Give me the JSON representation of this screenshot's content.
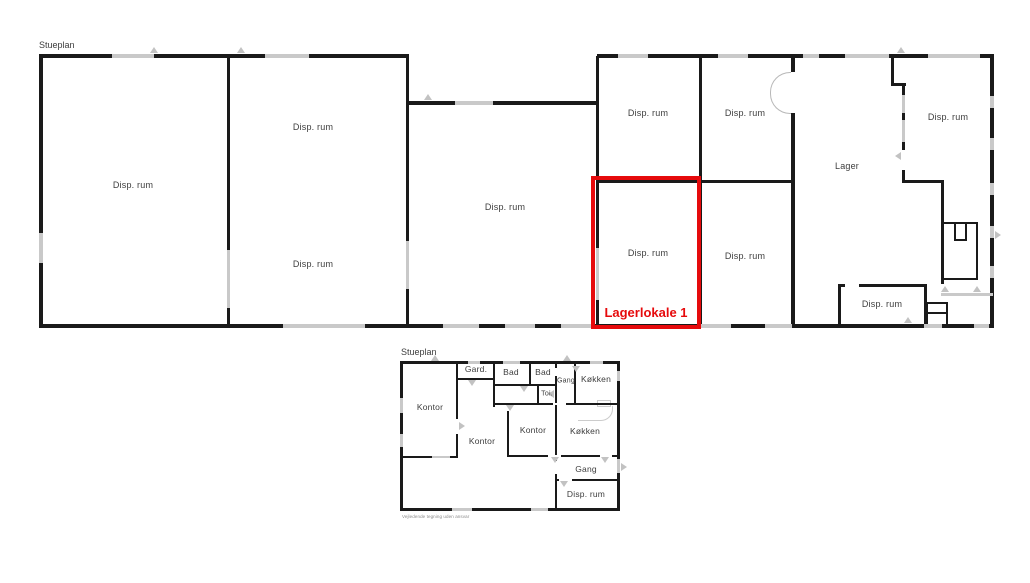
{
  "colors": {
    "wall": "#1a1a1a",
    "window": "#c9c9c9",
    "label_text": "#3d3d3d",
    "highlight_red": "#e60a0c",
    "disclaimer_text": "#8a8a8a"
  },
  "top_plan": {
    "title": "Stueplan",
    "rooms": [
      {
        "label": "Disp. rum"
      },
      {
        "label": "Disp. rum"
      },
      {
        "label": "Disp. rum"
      },
      {
        "label": "Disp. rum"
      },
      {
        "label": "Disp. rum"
      },
      {
        "label": "Disp. rum"
      },
      {
        "label": "Disp. rum"
      },
      {
        "label": "Disp. rum"
      },
      {
        "label": "Lager"
      },
      {
        "label": "Disp. rum"
      },
      {
        "label": "Disp. rum"
      }
    ],
    "highlight": {
      "label": "Lagerlokale 1"
    }
  },
  "bottom_plan": {
    "title": "Stueplan",
    "rooms": [
      {
        "label": "Kontor"
      },
      {
        "label": "Gard."
      },
      {
        "label": "Bad"
      },
      {
        "label": "Bad"
      },
      {
        "label": "Gang"
      },
      {
        "label": "Køkken"
      },
      {
        "label": "Toi."
      },
      {
        "label": "Kontor"
      },
      {
        "label": "Kontor"
      },
      {
        "label": "Køkken"
      },
      {
        "label": "Gang"
      },
      {
        "label": "Disp. rum"
      }
    ],
    "disclaimer": "Vejledende tegning uden ansvar"
  }
}
